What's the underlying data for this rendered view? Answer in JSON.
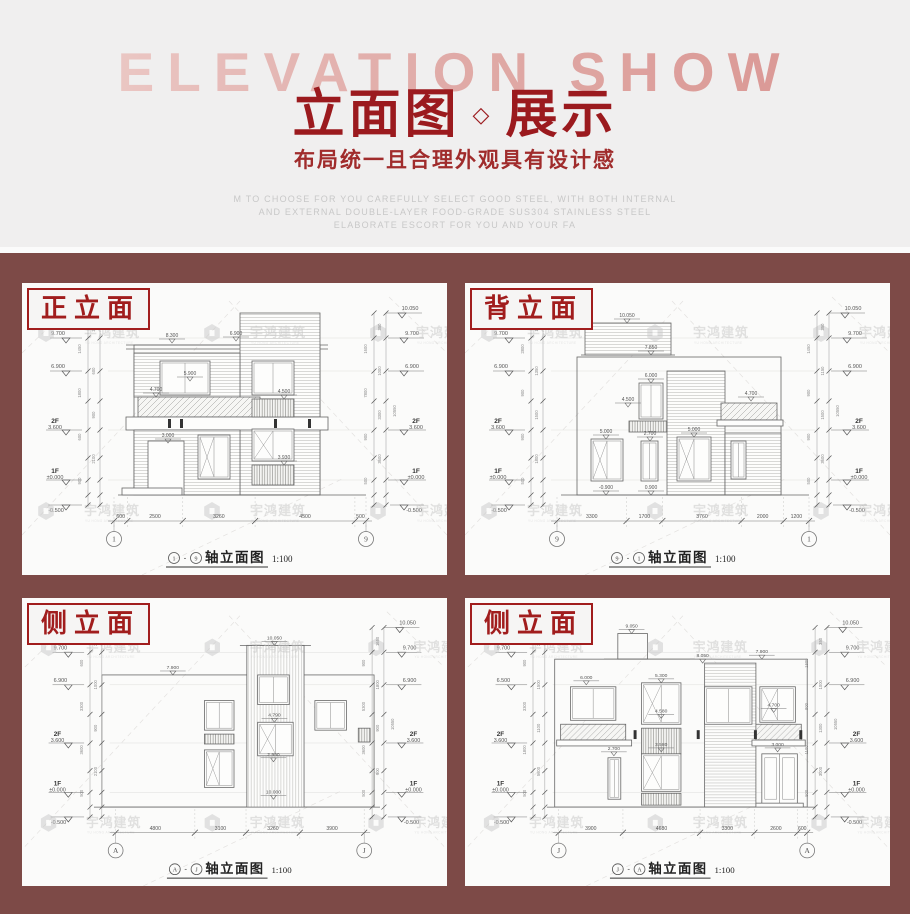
{
  "header": {
    "backdrop_title": "ELEVATION SHOW",
    "title": "立面图",
    "title_divider": "◇",
    "title_suffix": "展示",
    "subtitle": "布局统一且合理外观具有设计感",
    "description_lines": [
      "M TO CHOOSE FOR YOU CAREFULLY SELECT GOOD STEEL, WITH BOTH INTERNAL",
      "AND EXTERNAL DOUBLE-LAYER FOOD-GRADE SUS304 STAINLESS STEEL",
      "ELABORATE ESCORT FOR YOU AND YOUR FA"
    ]
  },
  "watermark": {
    "name": "宇鸿建筑",
    "subname": "YU HONG ARCHITECTURE"
  },
  "colors": {
    "page_bg": "#7d4a47",
    "header_bg": "#f0efef",
    "accent_red": "#9b1a1e",
    "label_red": "#a11d1d",
    "panel_bg": "#fbfbfa",
    "line": "#666666",
    "watermark": "#c9c9c9"
  },
  "panels": [
    {
      "label": "正立面",
      "axis_left": "1",
      "axis_right": "9",
      "caption_sep": "-",
      "caption_text": "轴立面图",
      "caption_scale": "1:100",
      "floor2_label": "2F",
      "floor2_elev": "3.600",
      "floor1_label": "1F",
      "floor1_elev": "±0.000",
      "levels_left": [
        "9.700",
        "6.900"
      ],
      "levels_right": [
        "10.050",
        "9.700",
        "6.900"
      ],
      "level_bottom": "-0.500",
      "vdims_left": [
        "2850",
        "1450",
        "600",
        "1800",
        "900",
        "600",
        "2100",
        "900"
      ],
      "vdims_right": [
        "350",
        "1600",
        "1000",
        "7800",
        "3300",
        "900",
        "3600",
        "500"
      ],
      "vtotal": "10550",
      "bottom_dims": [
        "600",
        "2500",
        "3260",
        "4500",
        "500"
      ],
      "annotations": [
        "8.300",
        "6.900",
        "5.900",
        "4.700",
        "4.500",
        "3.000",
        "3.930"
      ]
    },
    {
      "label": "背立面",
      "axis_left": "9",
      "axis_right": "1",
      "caption_sep": "-",
      "caption_text": "轴立面图",
      "caption_scale": "1:100",
      "floor2_label": "2F",
      "floor2_elev": "3.600",
      "floor1_label": "1F",
      "floor1_elev": "±0.000",
      "levels_left": [
        "9.700",
        "6.900"
      ],
      "levels_right": [
        "10.050",
        "9.700",
        "6.900"
      ],
      "level_bottom": "-0.500",
      "vdims_left": [
        "1450",
        "2800",
        "1350",
        "900",
        "1500",
        "900",
        "1800",
        "500"
      ],
      "vdims_right": [
        "350",
        "1450",
        "1150",
        "900",
        "1500",
        "900",
        "3600",
        "500"
      ],
      "vtotal": "10550",
      "bottom_dims": [
        "3300",
        "1700",
        "3760",
        "2000",
        "1200"
      ],
      "annotations": [
        "10.050",
        "7.850",
        "6.000",
        "4.500",
        "4.700",
        "5.000",
        "2.700",
        "5.000",
        "0.900",
        "-0.900"
      ]
    },
    {
      "label": "侧立面",
      "axis_left": "A",
      "axis_right": "J",
      "caption_sep": "-",
      "caption_text": "轴立面图",
      "caption_scale": "1:100",
      "floor2_label": "2F",
      "floor2_elev": "3.600",
      "floor1_label": "1F",
      "floor1_elev": "±0.000",
      "levels_left": [
        "9.700",
        "6.900"
      ],
      "levels_right": [
        "10.050",
        "9.700",
        "6.900"
      ],
      "level_bottom": "-0.500",
      "vdims_left": [
        "2850",
        "600",
        "1000",
        "3300",
        "900",
        "3600",
        "2100",
        "500"
      ],
      "vdims_right": [
        "1650",
        "900",
        "1800",
        "5300",
        "900",
        "3600",
        "900",
        "500"
      ],
      "vtotal": "10550",
      "bottom_dims": [
        "4800",
        "3100",
        "3260",
        "3900"
      ],
      "annotations": [
        "10.050",
        "7.900",
        "4.790",
        "2.990",
        "10.000"
      ]
    },
    {
      "label": "侧立面",
      "axis_left": "J",
      "axis_right": "A",
      "caption_sep": "-",
      "caption_text": "轴立面图",
      "caption_scale": "1:100",
      "floor2_label": "2F",
      "floor2_elev": "3.600",
      "floor1_label": "1F",
      "floor1_elev": "±0.000",
      "levels_left": [
        "9.700",
        "6.500"
      ],
      "levels_right": [
        "10.050",
        "9.700",
        "6.900"
      ],
      "level_bottom": "-0.500",
      "vdims_left": [
        "2850",
        "900",
        "1500",
        "3300",
        "1100",
        "1800",
        "5600",
        "500"
      ],
      "vdims_right": [
        "350",
        "1500",
        "1000",
        "900",
        "1300",
        "1100",
        "3000",
        "500"
      ],
      "vtotal": "10550",
      "bottom_dims": [
        "3900",
        "4680",
        "3300",
        "2600",
        "600"
      ],
      "annotations": [
        "9.050",
        "8.050",
        "7.900",
        "6.000",
        "5.300",
        "4.580",
        "4.700",
        "3.000",
        "3.580",
        "2.700"
      ]
    }
  ]
}
